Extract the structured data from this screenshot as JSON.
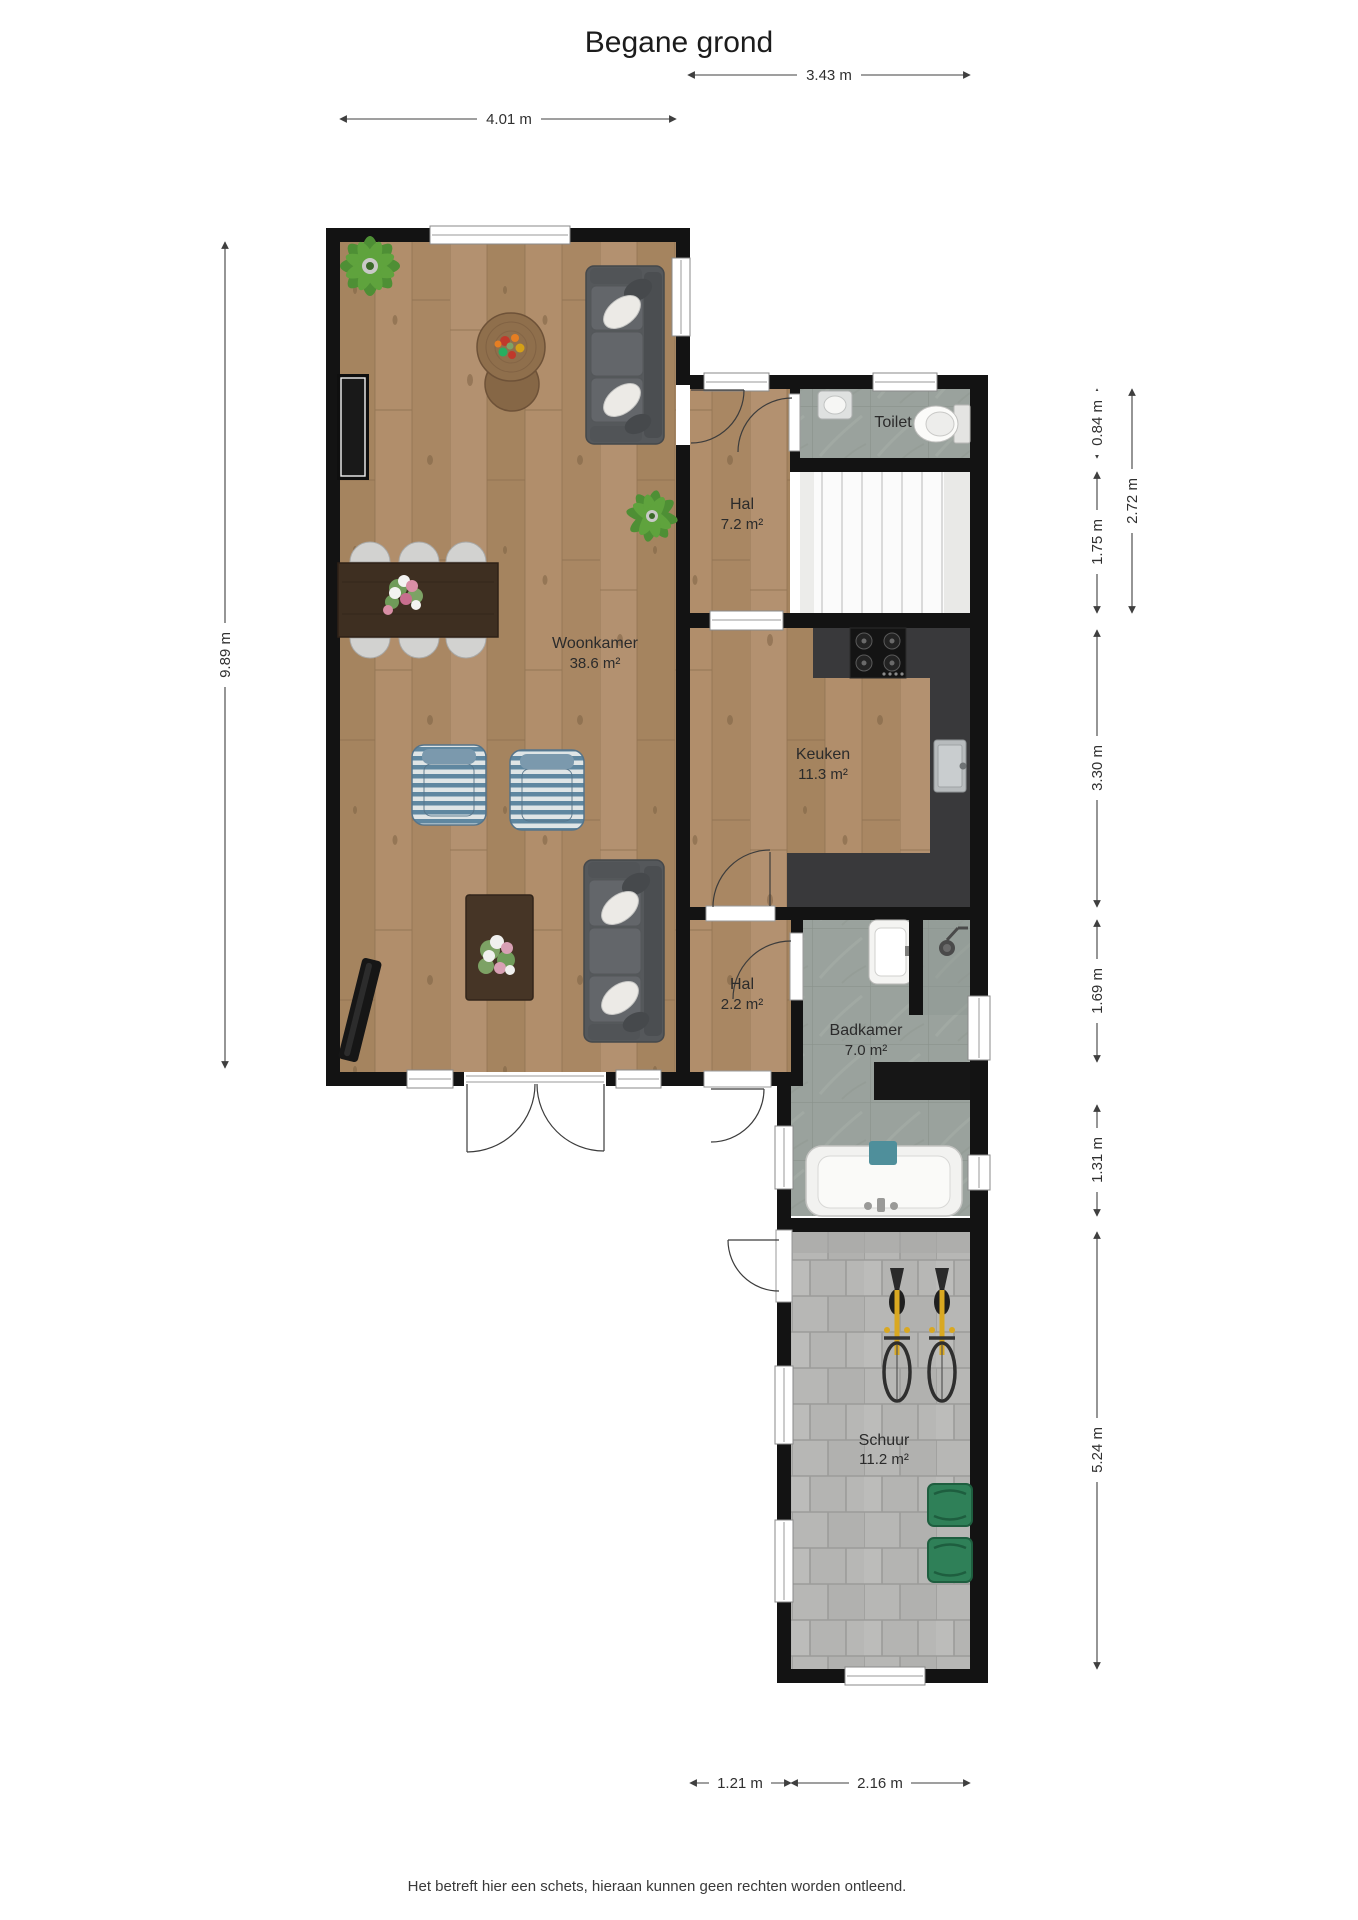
{
  "title": "Begane grond",
  "footer": "Het betreft hier een schets, hieraan kunnen geen rechten worden ontleend.",
  "rooms": {
    "woonkamer": {
      "name": "Woonkamer",
      "area": "38.6 m²"
    },
    "hal_boven": {
      "name": "Hal",
      "area": "7.2 m²"
    },
    "toilet": {
      "name": "Toilet"
    },
    "keuken": {
      "name": "Keuken",
      "area": "11.3 m²"
    },
    "hal_beneden": {
      "name": "Hal",
      "area": "2.2 m²"
    },
    "badkamer": {
      "name": "Badkamer",
      "area": "7.0 m²"
    },
    "schuur": {
      "name": "Schuur",
      "area": "11.2 m²"
    }
  },
  "dimensions": {
    "woonkamer_breedte": "4.01 m",
    "aanbouw_breedte": "3.43 m",
    "woonkamer_diepte": "9.89 m",
    "toilet_diepte": "0.84 m",
    "trap_diepte": "1.75 m",
    "hal_toilet_diepte": "2.72 m",
    "keuken_diepte": "3.30 m",
    "badkamer_diepte": "1.69 m",
    "bad_diepte": "1.31 m",
    "schuur_diepte": "5.24 m",
    "hal_breedte": "1.21 m",
    "schuur_breedte": "2.16 m"
  },
  "colors": {
    "wall": "#131313",
    "wood_floor": "#ab8a67",
    "bathroom_tile": "#9aa29d",
    "shed_paver": "#b7b7b5",
    "kitchen_counter": "#39393b",
    "crate_green": "#2f8058",
    "towel_teal": "#4f8f9b",
    "bike_yellow": "#d9a821",
    "dimension_line": "#3f3f3f"
  }
}
